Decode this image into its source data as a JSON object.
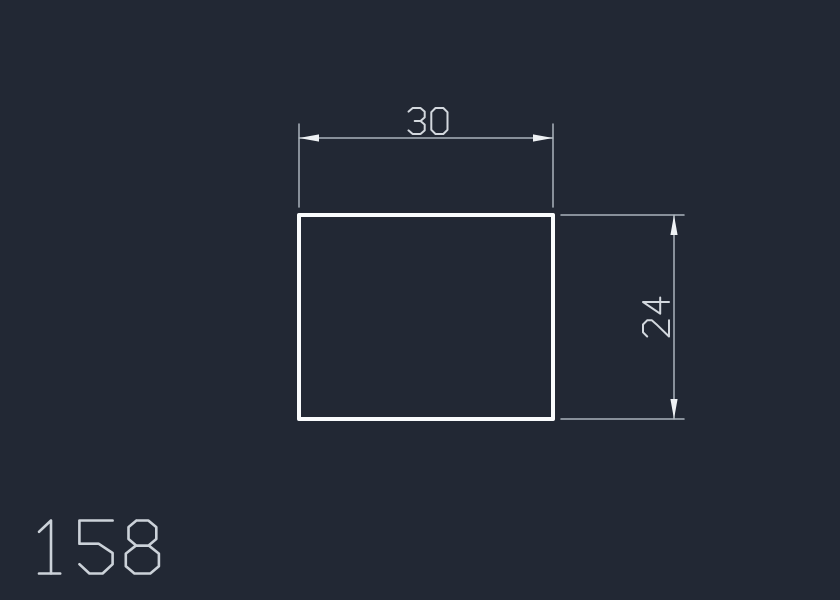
{
  "app": {
    "name": "cad-drawing-viewport"
  },
  "canvas": {
    "background": "#222834"
  },
  "drawing": {
    "part_number": "158",
    "shape": "rectangle",
    "dimensions": {
      "width": {
        "label": "30"
      },
      "height": {
        "label": "24"
      }
    }
  },
  "colors": {
    "outline": "#fafcfd",
    "dimension_line": "#aab3bc",
    "arrow": "#eef1f4",
    "dimension_text": "#d3d8de",
    "part_number_text": "#ccd2d9"
  }
}
